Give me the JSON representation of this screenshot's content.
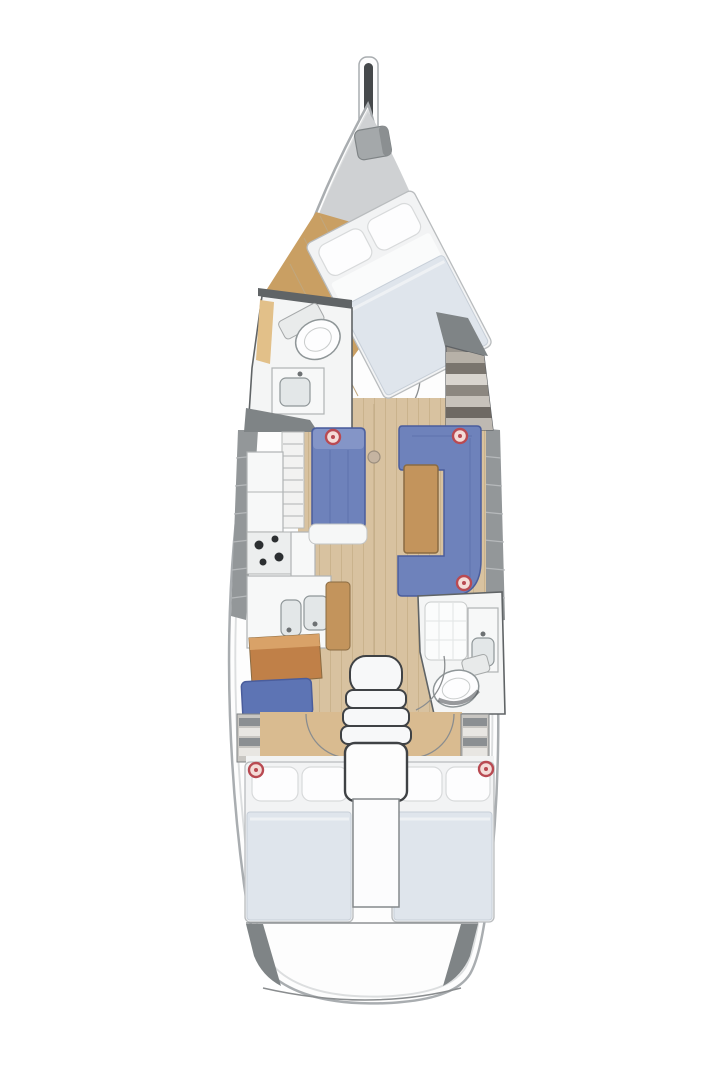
{
  "figure": {
    "title": "sailing-yacht-interior-floor-plan",
    "orientation": "bow-up",
    "rooms": [
      "foredeck",
      "owner-cabin",
      "forward-head",
      "salon",
      "galley",
      "nav-station",
      "aft-head",
      "aft-cabin-port",
      "aft-cabin-starboard",
      "companionway",
      "transom"
    ],
    "furniture": [
      "bow-sprit",
      "anchor-windlass",
      "owner-berth",
      "forward-toilet",
      "forward-sink",
      "wardrobe-shelves",
      "galley-rack",
      "galley-fridge",
      "galley-stove",
      "galley-double-sink",
      "chart-leaf",
      "port-settee",
      "salon-table",
      "starboard-u-sofa",
      "mast-post",
      "nav-desk",
      "nav-seat",
      "port-locker-shelves",
      "starboard-locker-shelves",
      "aft-shower",
      "aft-vanity-sink",
      "aft-toilet",
      "port-berth",
      "starboard-berth",
      "companionway-steps",
      "engine-box"
    ],
    "markers": {
      "count": 5,
      "style": "red-ring"
    }
  },
  "palette": {
    "pageBg": "#ffffff",
    "hullWhite": "#fdfdfd",
    "hullStroke": "#a9adb0",
    "hullInner": "#dcdedf",
    "deckGray": "#cfd1d3",
    "darkTrim": "#46494b",
    "windlassGray": "#a4a8aa",
    "linerGray": "#939799",
    "linerSeg": "#b6b9bb",
    "wedgeGray": "#7f8486",
    "wallDark": "#606466",
    "roomWhite": "#f4f5f5",
    "woodFloor": "#d8c2a0",
    "woodLine": "#c0a77e",
    "woodWarm": "#c99f63",
    "woodDesk": "#c08048",
    "woodDeskTop": "#d9a268",
    "woodTable": "#c3945c",
    "woodEdge": "#8a6b42",
    "sofaBlue": "#6e82bb",
    "sofaLight": "#8495c7",
    "sofaEdge": "#4a5d9c",
    "benchBlue": "#5d74b4",
    "bedWhite": "#f2f3f4",
    "bedEdge": "#b9bcbe",
    "pillowWhite": "#fdfdfe",
    "pillowEdge": "#d8dadb",
    "bedBlanket": "#dfe5ec",
    "blanketEdge": "#c7cfd8",
    "fixtureWhite": "#f7f8f8",
    "fixtureStroke": "#b0b3b4",
    "basinGray": "#e3e7e8",
    "basinStroke": "#8f9698",
    "burnerBlack": "#2c2f31",
    "stepWhite": "#f7f8f9",
    "stepStroke": "#3f4245",
    "stripeLight": "#e8e6e2",
    "stripeDark": "#8b8f92",
    "arcGray": "#8a8d8f",
    "markerRed": "#b94a52",
    "markerFill": "#f4dcd8",
    "mastGray": "#c5b4a1"
  }
}
